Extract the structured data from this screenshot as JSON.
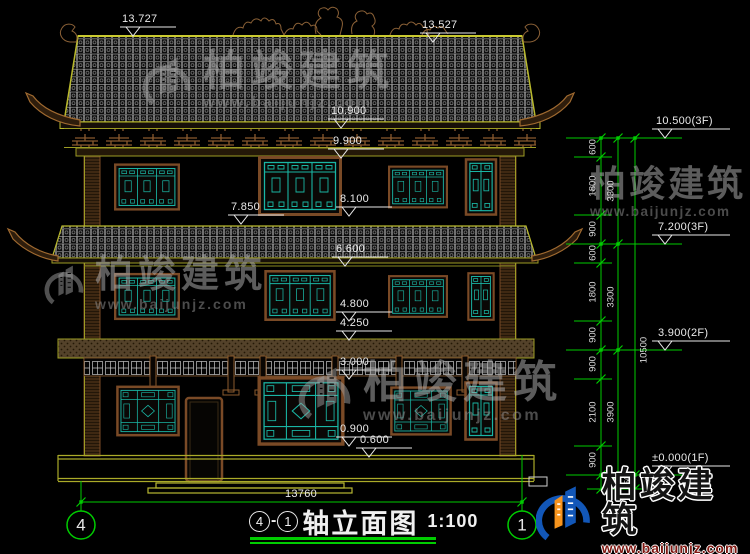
{
  "title_block": {
    "axis_start": "4",
    "axis_end": "1",
    "name": "轴立面图",
    "scale": "1:100"
  },
  "axis_bubbles": {
    "left": "4",
    "right": "1"
  },
  "bottom_dimension": "13760",
  "left_markers": [
    {
      "label": "13.727"
    },
    {
      "label": "13.527"
    },
    {
      "label": "10.900"
    },
    {
      "label": "9.900"
    },
    {
      "label": "8.100"
    },
    {
      "label": "7.850"
    },
    {
      "label": "6.600"
    },
    {
      "label": "4.800"
    },
    {
      "label": "4.250"
    },
    {
      "label": "3.000"
    },
    {
      "label": "0.900"
    },
    {
      "label": "0.600"
    }
  ],
  "right_markers": [
    {
      "label": "10.500(3F)"
    },
    {
      "label": "7.200(3F)"
    },
    {
      "label": "3.900(2F)"
    },
    {
      "label": "±0.000(1F)"
    }
  ],
  "right_dims": {
    "col1": [
      "600",
      "1800",
      "900",
      "600",
      "1800",
      "900",
      "900",
      "2100",
      "900"
    ],
    "col2": [
      "3300",
      "3300",
      "3900"
    ],
    "total": "10500",
    "below_grade": "450"
  },
  "watermark": {
    "company": "柏竣建筑",
    "website": "www.baijunjz.com"
  },
  "colors": {
    "dim_green": "#00cc00",
    "cad_yellow": "#a8a82a",
    "wood_brown": "#96642e",
    "window_teal": "#1ab5a4",
    "logo_blue": "#1257b8",
    "logo_orange": "#f7941d"
  }
}
